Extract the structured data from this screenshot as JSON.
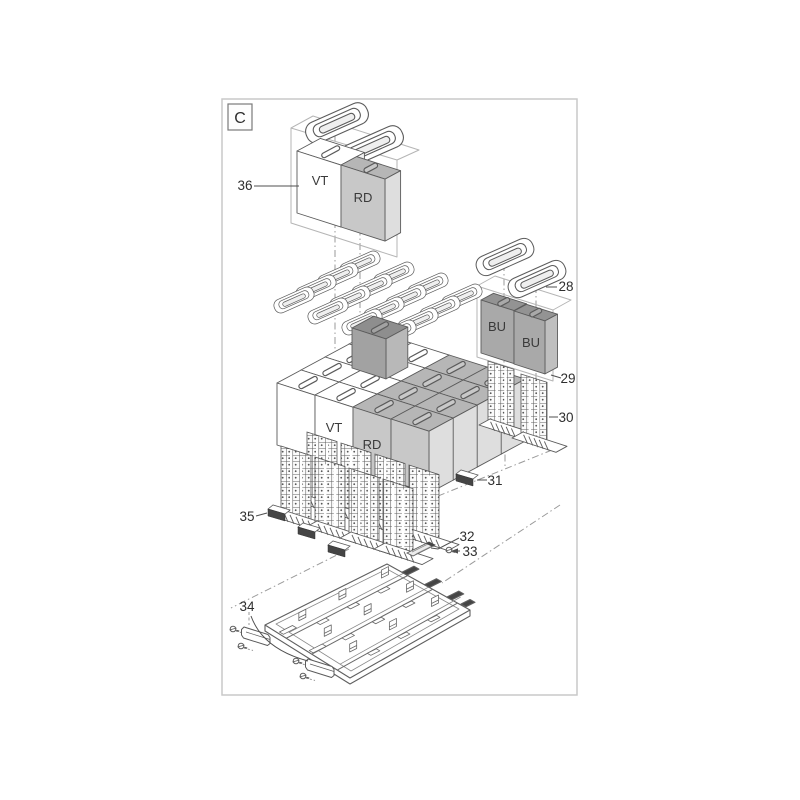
{
  "diagram": {
    "section_label": "C",
    "callouts": {
      "n28": "28",
      "n29": "29",
      "n30": "30",
      "n31": "31",
      "n32": "32",
      "n33": "33",
      "n34": "34",
      "n35": "35",
      "n36": "36"
    },
    "foam_labels": {
      "top_vt": "VT",
      "top_rd": "RD",
      "cluster_vt": "VT",
      "cluster_rd": "RD",
      "bu_left": "BU",
      "bu_right": "BU"
    },
    "colors": {
      "outline": "#5b5b5b",
      "frame_border": "#c9c9c9",
      "guide": "#9a9a9a",
      "foam_vt": "#ffffff",
      "foam_rd": "#c8c8c8",
      "foam_bu": "#a9a9a9",
      "foam_dark": "#a2a2a2",
      "clip_dark": "#454545",
      "container_outline": "#b5b5b5"
    }
  }
}
